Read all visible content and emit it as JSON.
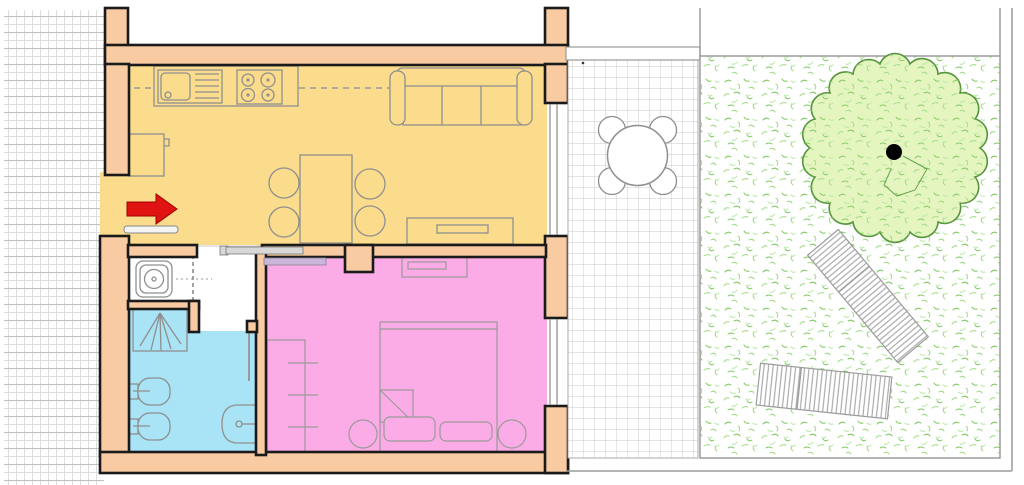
{
  "image_kind": "apartment-floor-plan-with-garden",
  "colors": {
    "wall": "#F8CBA3",
    "wall_outline": "#1A1A1A",
    "living_kitchen": "#FADC8C",
    "bedroom": "#FBACE6",
    "bathroom": "#A9E4F6",
    "closet_floor": "#FFFFFF",
    "hallway_floor": "#FFFFFF",
    "entrance_arrow": "#E01313",
    "entrance_arrow_outline": "#A00000",
    "entry_door_bar": "#F4F4F4",
    "door_bar": "#D8D8D8",
    "sliding_panel": "#C9B6D8",
    "furniture_line": "#8F8F8F",
    "appliance_fill": "#FFFFFF",
    "terrace_line": "#C9C9C9",
    "terrace_floor": "#FFFFFF",
    "boundary": "#9C9C9C",
    "tree_crown": "#E5F5C0",
    "tree_outline": "#55943C",
    "tree_trunk": "#000000",
    "grass_dark": "#7CC75C",
    "grass_mid": "#9AD97F",
    "grass_light": "#B7E8A2",
    "lounger_stripe": "#9A9A9A",
    "neighbor_grid_light": "#DEDEDE",
    "neighbor_grid_heavy": "#C2C2C2"
  },
  "plan": {
    "indoor_rooms": [
      {
        "name": "living-room-kitchen",
        "fill_key": "living_kitchen",
        "furniture": [
          "kitchen-counter-with-sink",
          "cooktop-4-burners",
          "fridge",
          "sofa-3-seats",
          "dining-table",
          "four-dining-chairs",
          "tv-cabinet"
        ]
      },
      {
        "name": "hallway",
        "fill_key": "hallway_floor",
        "furniture": [
          "closet-with-washing-machine",
          "folding-door"
        ]
      },
      {
        "name": "bathroom",
        "fill_key": "bathroom",
        "furniture": [
          "shower",
          "toilet",
          "bidet",
          "washbasin",
          "door-leaf"
        ]
      },
      {
        "name": "bedroom",
        "fill_key": "bedroom",
        "furniture": [
          "double-bed",
          "two-pillows",
          "folded-blanket-corner",
          "two-nightstands",
          "wardrobe",
          "dresser",
          "sliding-door"
        ]
      }
    ],
    "openings": [
      "entrance-with-red-arrow",
      "living-room-window",
      "bedroom-window"
    ],
    "outdoor_areas": [
      {
        "name": "terrace",
        "features": [
          "tile-paving",
          "round-table-with-four-chairs",
          "threshold-step"
        ]
      },
      {
        "name": "garden",
        "features": [
          "grass",
          "tree-with-trunk-dot",
          "sun-lounger-diagonal",
          "sun-lounger-horizontal",
          "fence-boundary"
        ]
      }
    ],
    "neighbor_area": "hatched-grid-left-strip"
  }
}
